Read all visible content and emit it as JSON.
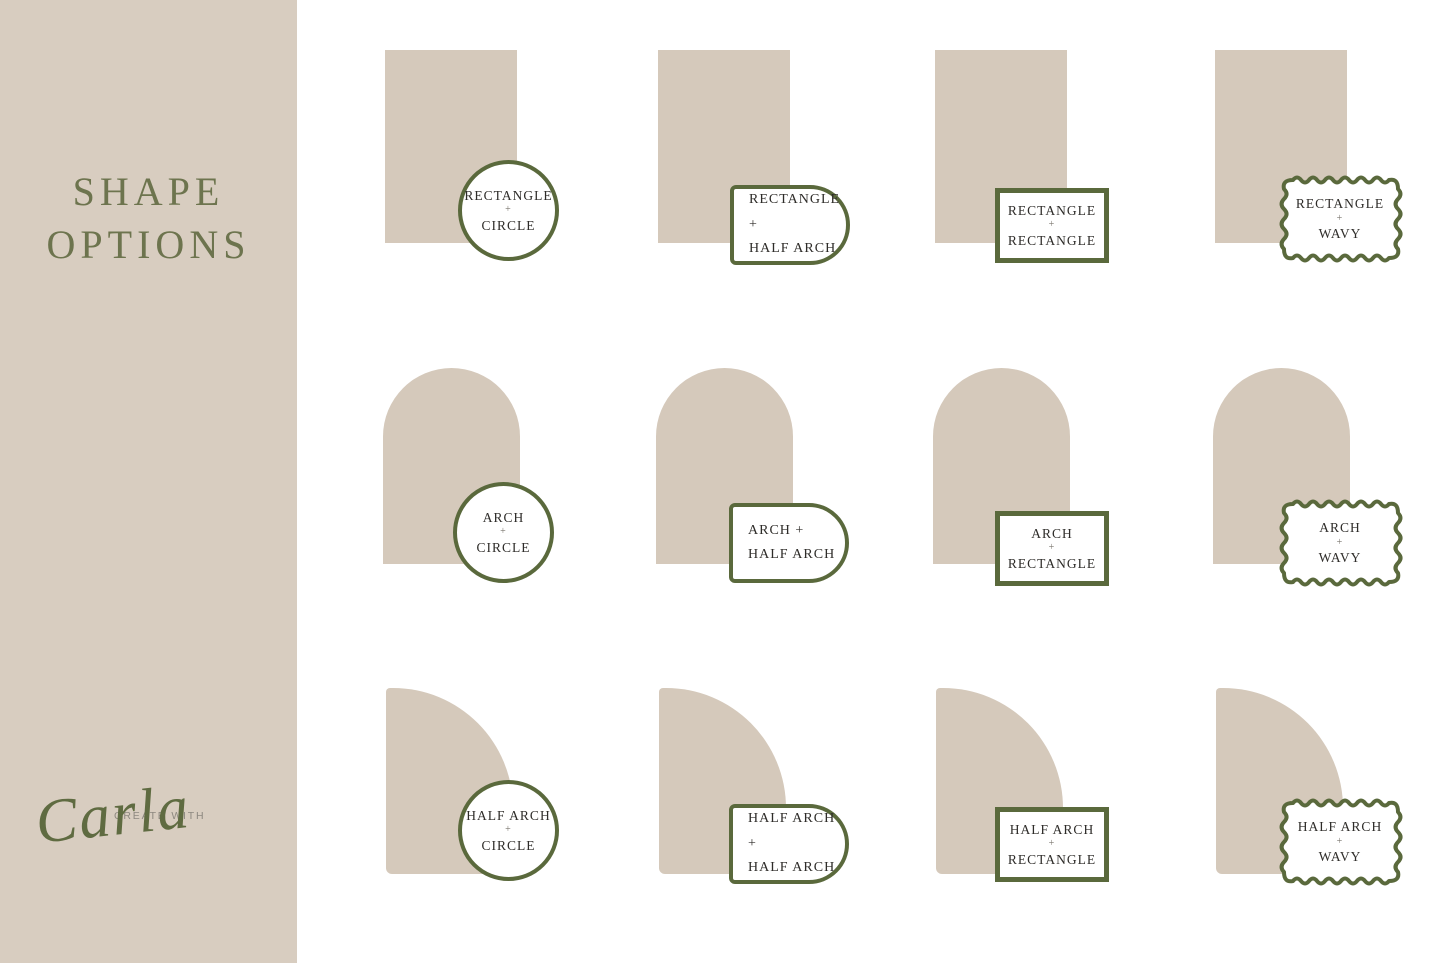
{
  "sidebar": {
    "title_line1": "SHAPE",
    "title_line2": "OPTIONS",
    "logo_small": "CREATE WITH",
    "logo_script": "Carla"
  },
  "colors": {
    "beige-sidebar": "#d8cdc0",
    "beige-shape": "#d5c9bb",
    "accent-green": "#5a693c",
    "title-green": "#6d744e",
    "script-green": "#5f6b41",
    "label-ink": "#2e2c29"
  },
  "tiles": [
    {
      "shape": "rectangle",
      "badge": "circle",
      "lines": [
        "RECTANGLE",
        "+",
        "CIRCLE"
      ]
    },
    {
      "shape": "rectangle",
      "badge": "half-arch",
      "lines": [
        "RECTANGLE +",
        "HALF ARCH"
      ]
    },
    {
      "shape": "rectangle",
      "badge": "rectangle",
      "lines": [
        "RECTANGLE",
        "+",
        "RECTANGLE"
      ]
    },
    {
      "shape": "rectangle",
      "badge": "wavy",
      "lines": [
        "RECTANGLE",
        "+",
        "WAVY"
      ]
    },
    {
      "shape": "arch",
      "badge": "circle",
      "lines": [
        "ARCH",
        "+",
        "CIRCLE"
      ]
    },
    {
      "shape": "arch",
      "badge": "half-arch",
      "lines": [
        "ARCH +",
        "HALF ARCH"
      ]
    },
    {
      "shape": "arch",
      "badge": "rectangle",
      "lines": [
        "ARCH",
        "+",
        "RECTANGLE"
      ]
    },
    {
      "shape": "arch",
      "badge": "wavy",
      "lines": [
        "ARCH",
        "+",
        "WAVY"
      ]
    },
    {
      "shape": "half-arch",
      "badge": "circle",
      "lines": [
        "HALF ARCH",
        "+",
        "CIRCLE"
      ]
    },
    {
      "shape": "half-arch",
      "badge": "half-arch",
      "lines": [
        "HALF ARCH +",
        "HALF ARCH"
      ]
    },
    {
      "shape": "half-arch",
      "badge": "rectangle",
      "lines": [
        "HALF ARCH",
        "+",
        "RECTANGLE"
      ]
    },
    {
      "shape": "half-arch",
      "badge": "wavy",
      "lines": [
        "HALF ARCH",
        "+",
        "WAVY"
      ]
    }
  ]
}
